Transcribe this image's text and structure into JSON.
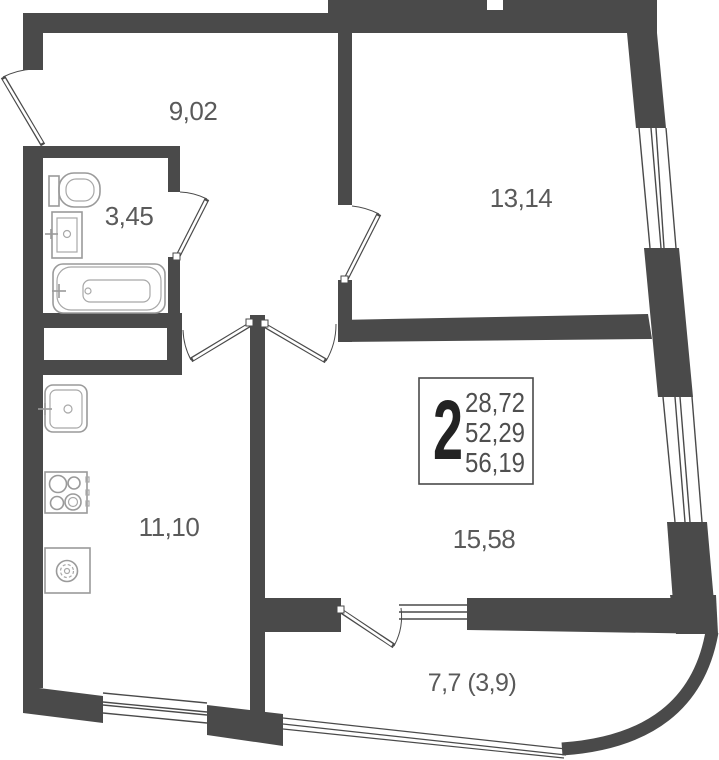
{
  "plan": {
    "kind": "apartment floor plan",
    "rooms": {
      "hallway": {
        "area_label": "9,02"
      },
      "bathroom": {
        "area_label": "3,45"
      },
      "bedroom": {
        "area_label": "13,14"
      },
      "kitchen": {
        "area_label": "11,10"
      },
      "living_room": {
        "area_label": "15,58"
      },
      "balcony": {
        "area_label": "7,7 (3,9)"
      }
    },
    "info_box": {
      "room_count": "2",
      "areas": [
        "28,72",
        "52,29",
        "56,19"
      ]
    },
    "colors": {
      "wall": "#4a4a4a",
      "fixture_stroke": "#9a9a9a",
      "label_text": "#5a5a5a"
    },
    "fixture_icons": [
      "toilet-icon",
      "wash-basin-icon",
      "bathtub-icon",
      "kitchen-sink-icon",
      "stove-icon",
      "washing-machine-icon"
    ]
  }
}
